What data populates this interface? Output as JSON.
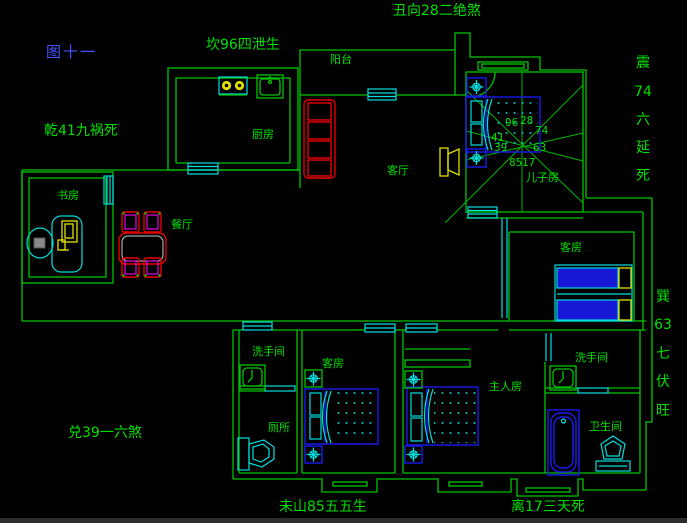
{
  "app": {
    "type": "cad-floor-plan",
    "background": "#000000"
  },
  "colors": {
    "wall_green": "#00c400",
    "text_green": "#00e000",
    "window_cyan": "#00dede",
    "furniture_blue": "#1b1bee",
    "accent_yellow": "#e2e200",
    "sofa_red": "#e50000",
    "chair_magenta": "#e500e5",
    "figure_blue": "#4653ff"
  },
  "annotations": {
    "figure_label": "图十一",
    "top": "丑向28二绝煞",
    "north": "坎96四泄生",
    "northwest": "乾41九祸死",
    "west": "兑39一六煞",
    "southwest": "未山85五五生",
    "south": "离17三天死",
    "east_chars": [
      "震",
      "74",
      "六",
      "延",
      "死"
    ],
    "southeast_chars": [
      "巽",
      "63",
      "七",
      "伏",
      "旺"
    ]
  },
  "rooms": {
    "balcony": "阳台",
    "kitchen": "厨房",
    "living": "客厅",
    "study": "书房",
    "dining": "餐厅",
    "son_room": "儿子房",
    "guest_right": "客房",
    "guest_bottom": "客房",
    "master": "主人房",
    "washroom_left": "洗手间",
    "toilet": "厕所",
    "washroom_right": "洗手间",
    "bathroom": "卫生间"
  },
  "compass": {
    "n_left": "96",
    "n_right": "28",
    "w_upper": "41",
    "e_upper": "74",
    "w_lower": "39",
    "e_lower": "63",
    "s_left": "85",
    "s_right": "17"
  }
}
